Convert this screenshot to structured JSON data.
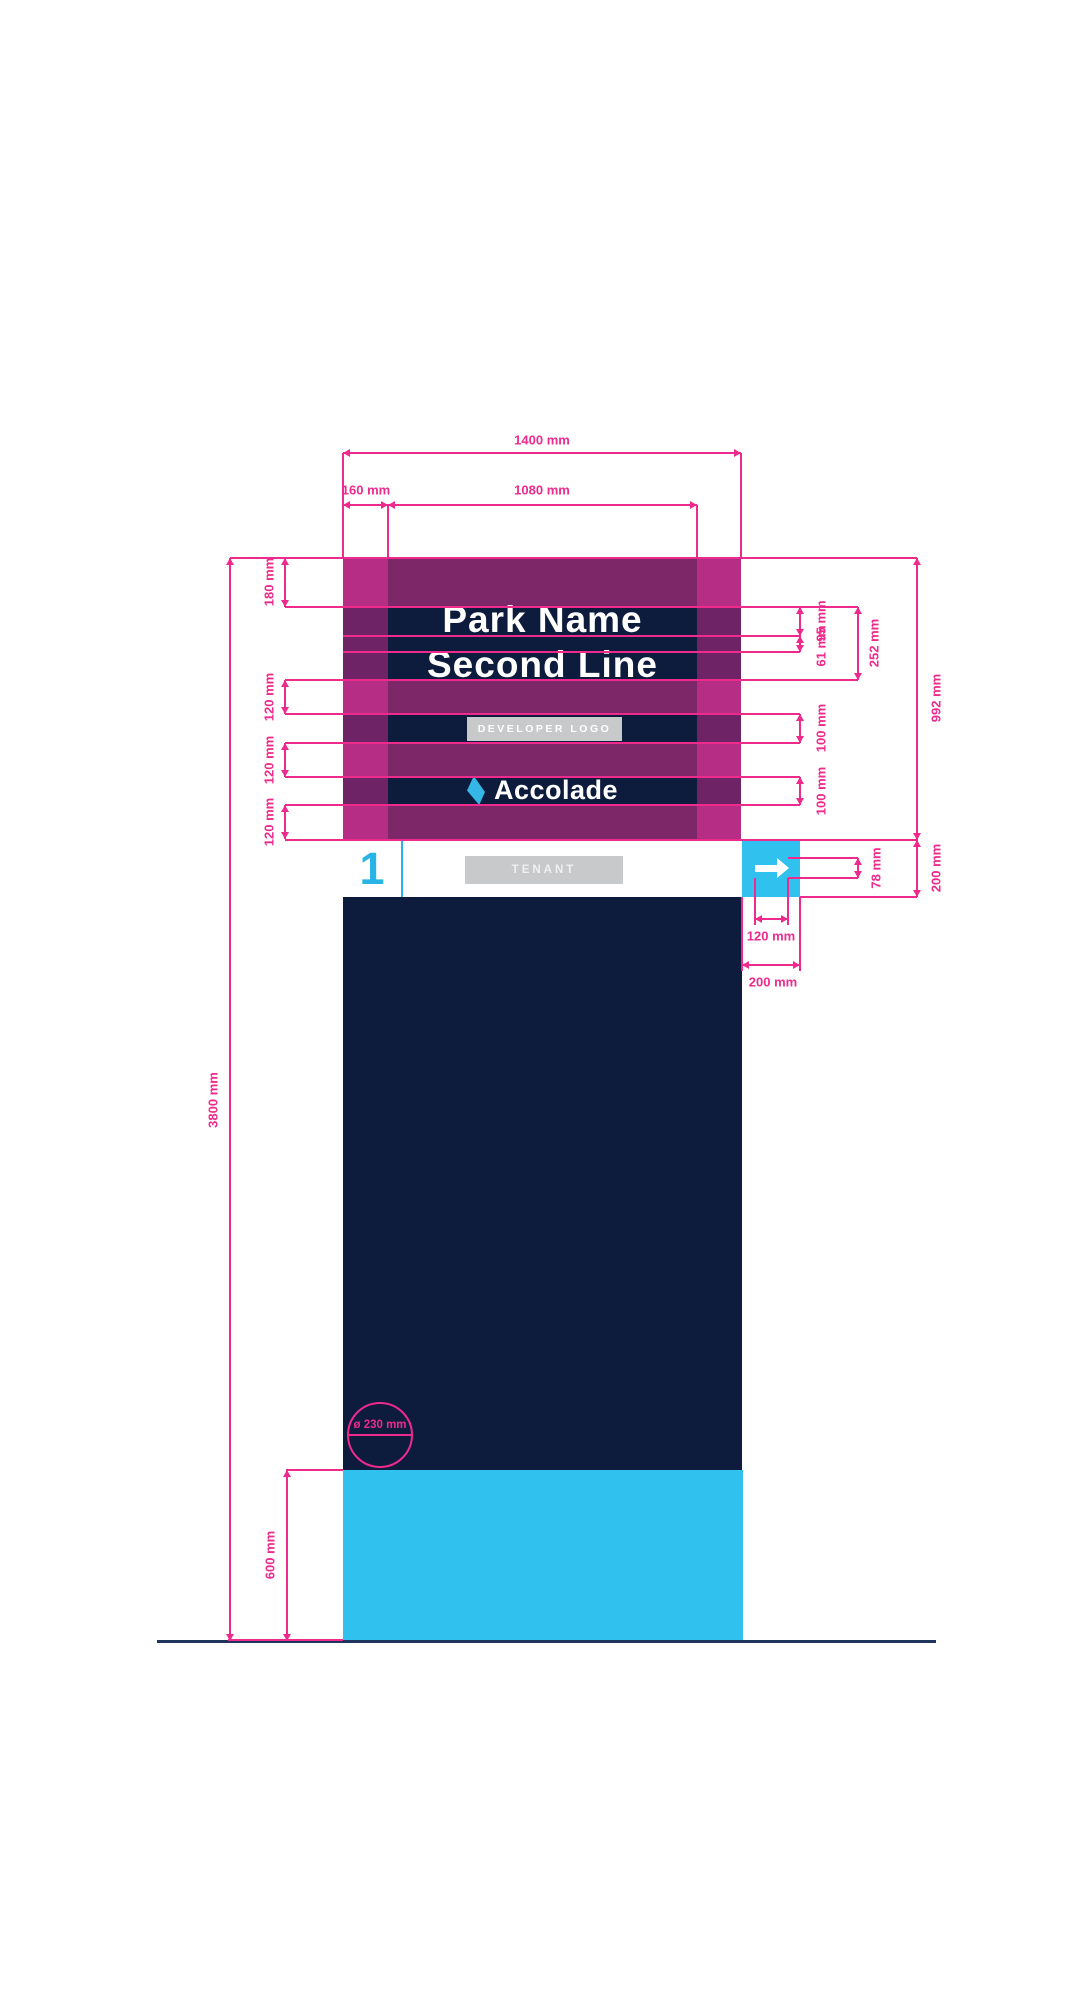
{
  "sign": {
    "park_name_line1": "Park Name",
    "park_name_line2": "Second Line",
    "developer_logo_label": "DEVELOPER LOGO",
    "brand_name": "Accolade",
    "tenant_number": "1",
    "tenant_label": "TENANT",
    "post_diameter_label": "ø 230 mm"
  },
  "colors": {
    "pink_dimension": "#ee2b8d",
    "navy": "#0d1b3d",
    "band_purple": "#7d2769",
    "margin_purple": "#6d2365",
    "overlay_magenta": "#b62d86",
    "cyan": "#30c1ee",
    "logo_cyan": "#35b7e5",
    "placeholder_gray": "#c8c9ca",
    "ground": "#20355e"
  },
  "dims": [
    {
      "label": "1400 mm",
      "orient": "h",
      "x": 343,
      "y": 453,
      "len": 398,
      "lx": 542,
      "ly": 440,
      "rot": false
    },
    {
      "label": "160 mm",
      "orient": "h",
      "x": 343,
      "y": 505,
      "len": 45,
      "lx": 366,
      "ly": 490,
      "rot": false
    },
    {
      "label": "1080 mm",
      "orient": "h",
      "x": 388,
      "y": 505,
      "len": 309,
      "lx": 542,
      "ly": 490,
      "rot": false
    },
    {
      "label": "180 mm",
      "orient": "v",
      "x": 285,
      "y": 558,
      "len": 49,
      "lx": 269,
      "ly": 582,
      "rot": true
    },
    {
      "label": "120 mm",
      "orient": "v",
      "x": 285,
      "y": 680,
      "len": 34,
      "lx": 269,
      "ly": 697,
      "rot": true
    },
    {
      "label": "120 mm",
      "orient": "v",
      "x": 285,
      "y": 743,
      "len": 34,
      "lx": 269,
      "ly": 760,
      "rot": true
    },
    {
      "label": "120 mm",
      "orient": "v",
      "x": 285,
      "y": 805,
      "len": 34,
      "lx": 269,
      "ly": 822,
      "rot": true
    },
    {
      "label": "95 mm",
      "orient": "v",
      "x": 800,
      "y": 607,
      "len": 29,
      "lx": 821,
      "ly": 621,
      "rot": true
    },
    {
      "label": "61 mm",
      "orient": "v",
      "x": 800,
      "y": 636,
      "len": 16,
      "lx": 821,
      "ly": 646,
      "rot": true
    },
    {
      "label": "252 mm",
      "orient": "v",
      "x": 858,
      "y": 607,
      "len": 73,
      "lx": 874,
      "ly": 643,
      "rot": true
    },
    {
      "label": "100 mm",
      "orient": "v",
      "x": 800,
      "y": 714,
      "len": 29,
      "lx": 821,
      "ly": 728,
      "rot": true
    },
    {
      "label": "100 mm",
      "orient": "v",
      "x": 800,
      "y": 777,
      "len": 28,
      "lx": 821,
      "ly": 791,
      "rot": true
    },
    {
      "label": "992 mm",
      "orient": "v",
      "x": 917,
      "y": 558,
      "len": 282,
      "lx": 936,
      "ly": 698,
      "rot": true
    },
    {
      "label": "200 mm",
      "orient": "v",
      "x": 917,
      "y": 840,
      "len": 57,
      "lx": 936,
      "ly": 868,
      "rot": true
    },
    {
      "label": "78 mm",
      "orient": "v",
      "x": 858,
      "y": 858,
      "len": 20,
      "lx": 876,
      "ly": 868,
      "rot": true
    },
    {
      "label": "120 mm",
      "orient": "h",
      "x": 755,
      "y": 919,
      "len": 33,
      "lx": 771,
      "ly": 936,
      "rot": false
    },
    {
      "label": "200 mm",
      "orient": "h",
      "x": 742,
      "y": 965,
      "len": 58,
      "lx": 773,
      "ly": 982,
      "rot": false
    },
    {
      "label": "3800 mm",
      "orient": "v",
      "x": 230,
      "y": 558,
      "len": 1083,
      "lx": 213,
      "ly": 1100,
      "rot": true
    },
    {
      "label": "600 mm",
      "orient": "v",
      "x": 287,
      "y": 1470,
      "len": 171,
      "lx": 270,
      "ly": 1555,
      "rot": true
    }
  ],
  "ext_lines": [
    {
      "x": 230,
      "y": 557,
      "w": 687,
      "h": 2
    },
    {
      "x": 285,
      "y": 606,
      "w": 573,
      "h": 2
    },
    {
      "x": 343,
      "y": 635,
      "w": 457,
      "h": 2
    },
    {
      "x": 343,
      "y": 651,
      "w": 457,
      "h": 2
    },
    {
      "x": 285,
      "y": 679,
      "w": 573,
      "h": 2
    },
    {
      "x": 285,
      "y": 713,
      "w": 515,
      "h": 2
    },
    {
      "x": 285,
      "y": 742,
      "w": 515,
      "h": 2
    },
    {
      "x": 285,
      "y": 776,
      "w": 515,
      "h": 2
    },
    {
      "x": 285,
      "y": 804,
      "w": 515,
      "h": 2
    },
    {
      "x": 285,
      "y": 839,
      "w": 632,
      "h": 2
    },
    {
      "x": 342,
      "y": 453,
      "w": 2,
      "h": 105
    },
    {
      "x": 740,
      "y": 453,
      "w": 2,
      "h": 105
    },
    {
      "x": 387,
      "y": 505,
      "w": 2,
      "h": 53
    },
    {
      "x": 696,
      "y": 505,
      "w": 2,
      "h": 53
    },
    {
      "x": 788,
      "y": 857,
      "w": 70,
      "h": 2
    },
    {
      "x": 788,
      "y": 877,
      "w": 70,
      "h": 2
    },
    {
      "x": 800,
      "y": 896,
      "w": 117,
      "h": 2
    },
    {
      "x": 754,
      "y": 878,
      "w": 2,
      "h": 47
    },
    {
      "x": 787,
      "y": 878,
      "w": 2,
      "h": 47
    },
    {
      "x": 741,
      "y": 897,
      "w": 2,
      "h": 74
    },
    {
      "x": 799,
      "y": 897,
      "w": 2,
      "h": 74
    },
    {
      "x": 286,
      "y": 1469,
      "w": 57,
      "h": 2
    },
    {
      "x": 228,
      "y": 1639,
      "w": 115,
      "h": 2
    }
  ]
}
